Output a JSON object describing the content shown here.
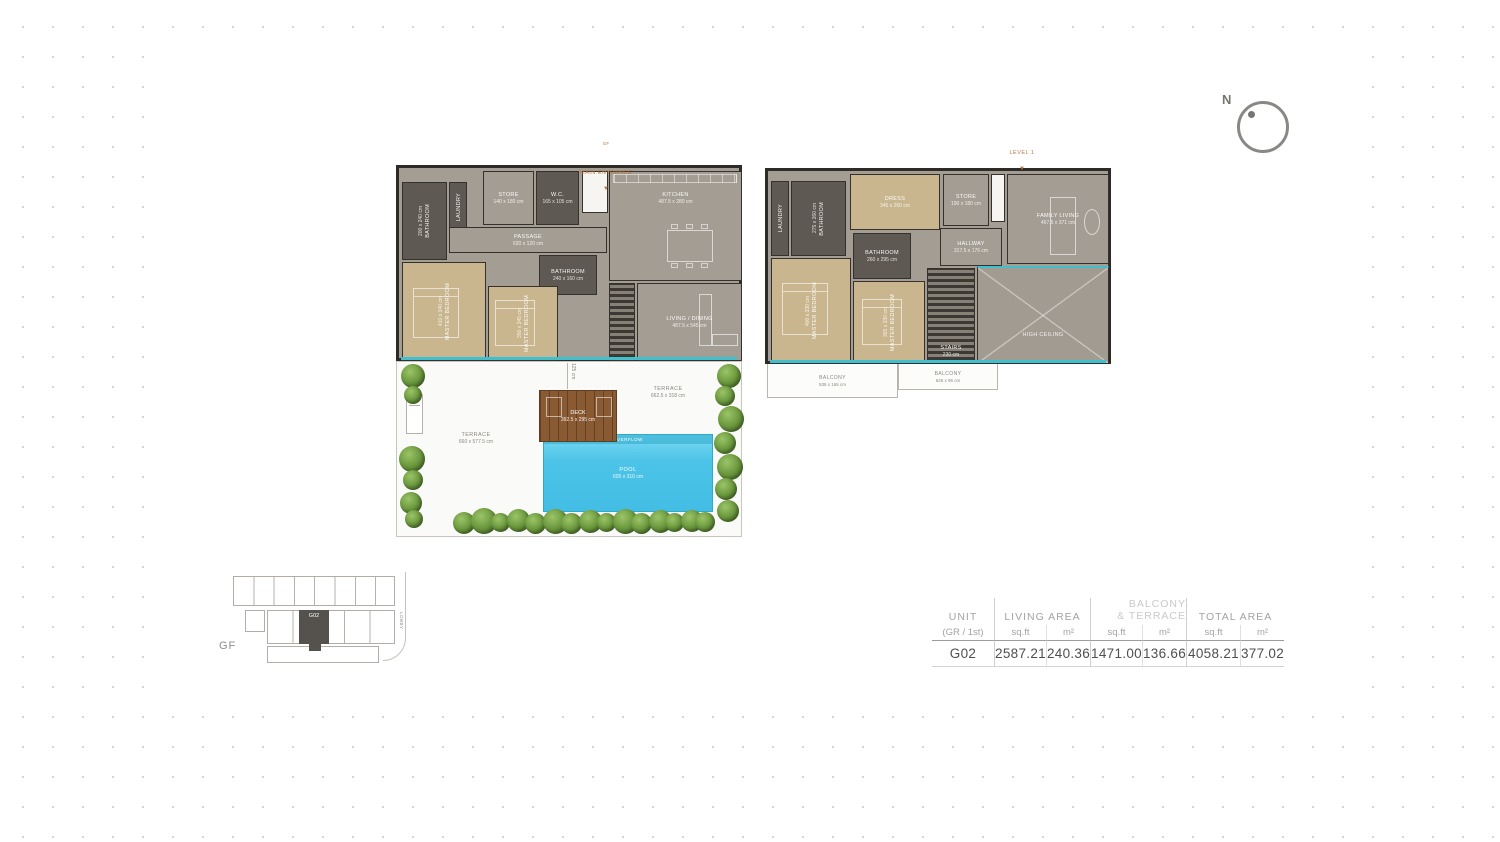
{
  "compass": {
    "north_label": "N"
  },
  "gf_plan": {
    "entrance_tag": "GF",
    "entrance_label": "MAIN ENTRANCE",
    "rooms": {
      "bathroom1": {
        "name": "BATHROOM",
        "dims": "200 x 240 cm"
      },
      "laundry": {
        "name": "LAUNDRY",
        "dims": ""
      },
      "store": {
        "name": "STORE",
        "dims": "140 x 180 cm"
      },
      "wc": {
        "name": "W.C.",
        "dims": "165 x 105 cm"
      },
      "kitchen": {
        "name": "KITCHEN",
        "dims": "487.5 x 280 cm"
      },
      "passage": {
        "name": "PASSAGE",
        "dims": "620 x 120 cm"
      },
      "bathroom2": {
        "name": "BATHROOM",
        "dims": "240 x 160 cm"
      },
      "bed1": {
        "name": "MASTER BEDROOM",
        "dims": "410 x 340 cm"
      },
      "bed2": {
        "name": "MASTER BEDROOM",
        "dims": "350 x 345 cm"
      },
      "living": {
        "name": "LIVING / DINING",
        "dims": "487.5 x 545 cm"
      }
    },
    "outdoor": {
      "terrace_left": {
        "name": "TERRACE",
        "dims": "660 x 577.5 cm"
      },
      "terrace_right": {
        "name": "TERRACE",
        "dims": "662.5 x 318 cm"
      },
      "deck": {
        "name": "DECK",
        "dims": "392.5 x 295 cm"
      },
      "pool": {
        "name": "POOL",
        "dims": "605 x 310 cm"
      },
      "overflow_label": "OVERFLOW",
      "dim_label": "125 cm"
    }
  },
  "l1_plan": {
    "level_tag": "LEVEL 1",
    "rooms": {
      "laundry": {
        "name": "LAUNDRY",
        "dims": ""
      },
      "bathroom1": {
        "name": "BATHROOM",
        "dims": "275 x 260 cm"
      },
      "dress": {
        "name": "DRESS",
        "dims": "345 x 260 cm"
      },
      "bathroom2": {
        "name": "BATHROOM",
        "dims": "260 x 295 cm"
      },
      "store": {
        "name": "STORE",
        "dims": "190 x 180 cm"
      },
      "family": {
        "name": "FAMILY LIVING",
        "dims": "467.5 x 371 cm"
      },
      "hallway": {
        "name": "HALLWAY",
        "dims": "317.5 x 176 cm"
      },
      "bed1": {
        "name": "MASTER BEDROOM",
        "dims": "400 x 330 cm"
      },
      "bed2": {
        "name": "MASTER BEDROOM",
        "dims": "365 x 330 cm"
      },
      "stairs": {
        "name": "STAIRS",
        "dims": "230 cm"
      },
      "high_ceiling": {
        "name": "HIGH CEILING",
        "dims": ""
      }
    },
    "balconies": {
      "balcony1": {
        "name": "BALCONY",
        "dims": "535 x 165 cm"
      },
      "balcony2": {
        "name": "BALCONY",
        "dims": "625 x 95 cm"
      }
    }
  },
  "key_plan": {
    "floor_label": "GF",
    "highlighted_unit": "G02",
    "lobby_label": "LOBBY"
  },
  "area_table": {
    "headers": {
      "unit_title": "UNIT",
      "unit_subtitle": "(GR / 1st)",
      "living_title": "LIVING AREA",
      "balcony_title_line1": "BALCONY",
      "balcony_title_line2": "& TERRACE",
      "total_title": "TOTAL AREA",
      "sqft": "sq.ft",
      "sqm": "m²"
    },
    "row": {
      "unit": "G02",
      "living_sqft": "2587.21",
      "living_sqm": "240.36",
      "balcony_sqft": "1471.00",
      "balcony_sqm": "136.66",
      "total_sqft": "4058.21",
      "total_sqm": "377.02"
    }
  }
}
